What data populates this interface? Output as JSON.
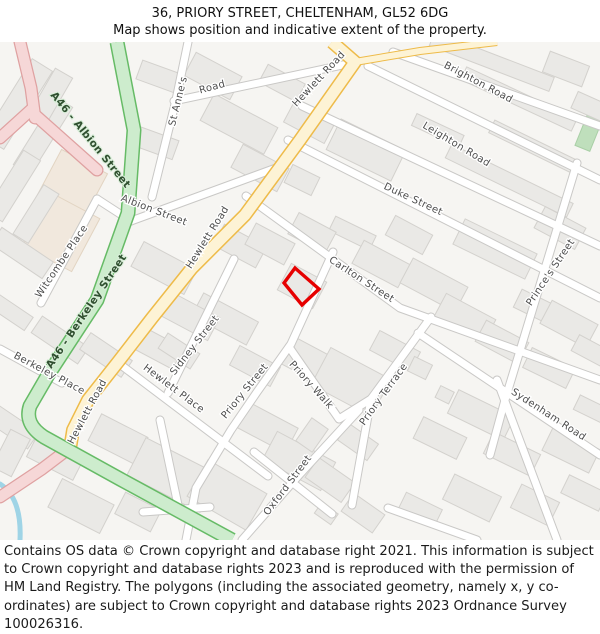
{
  "header": {
    "title": "36, PRIORY STREET, CHELTENHAM, GL52 6DG",
    "subtitle": "Map shows position and indicative extent of the property."
  },
  "map": {
    "property": {
      "address": "36, Priory Street, Cheltenham, GL52 6DG",
      "outline_color": "#e60000"
    },
    "colors": {
      "a_road_green_fill": "#cdeccd",
      "a_road_green_border": "#66bb66",
      "secondary_road_yellow_fill": "#fdf3d5",
      "secondary_road_yellow_border": "#eebb49",
      "primary_road_pink_fill": "#f6d7d7",
      "primary_road_pink_border": "#dfa1a1",
      "street_fill": "#ffffff",
      "street_border": "#c9c8c6",
      "building_fill": "#eae9e6",
      "retail_building_fill": "#f1e8dd",
      "park_fill": "#bfdfbc",
      "water": "#9fd4e6",
      "background": "#f6f5f2"
    },
    "labels": [
      {
        "text": "A46 - Albion Street"
      },
      {
        "text": "A46 - Berkeley Street"
      },
      {
        "text": "St Anne's"
      },
      {
        "text": "Road"
      },
      {
        "text": "Albion Street"
      },
      {
        "text": "Hewlett Road"
      },
      {
        "text": "Hewlett Road"
      },
      {
        "text": "Hewlett Road"
      },
      {
        "text": "Brighton Road"
      },
      {
        "text": "Leighton Road"
      },
      {
        "text": "Duke Street"
      },
      {
        "text": "Carlton Street"
      },
      {
        "text": "Prince's Street"
      },
      {
        "text": "Witcombe Place"
      },
      {
        "text": "Berkeley Place"
      },
      {
        "text": "Sidney Street"
      },
      {
        "text": "Hewlett Place"
      },
      {
        "text": "Priory Street"
      },
      {
        "text": "Priory Walk"
      },
      {
        "text": "Priory Terrace"
      },
      {
        "text": "Oxford Street"
      },
      {
        "text": "Sydenham Road"
      }
    ]
  },
  "footer": {
    "copyright": "Contains OS data © Crown copyright and database right 2021. This information is subject to Crown copyright and database rights 2023 and is reproduced with the permission of HM Land Registry. The polygons (including the associated geometry, namely x, y co-ordinates) are subject to Crown copyright and database rights 2023 Ordnance Survey 100026316."
  }
}
